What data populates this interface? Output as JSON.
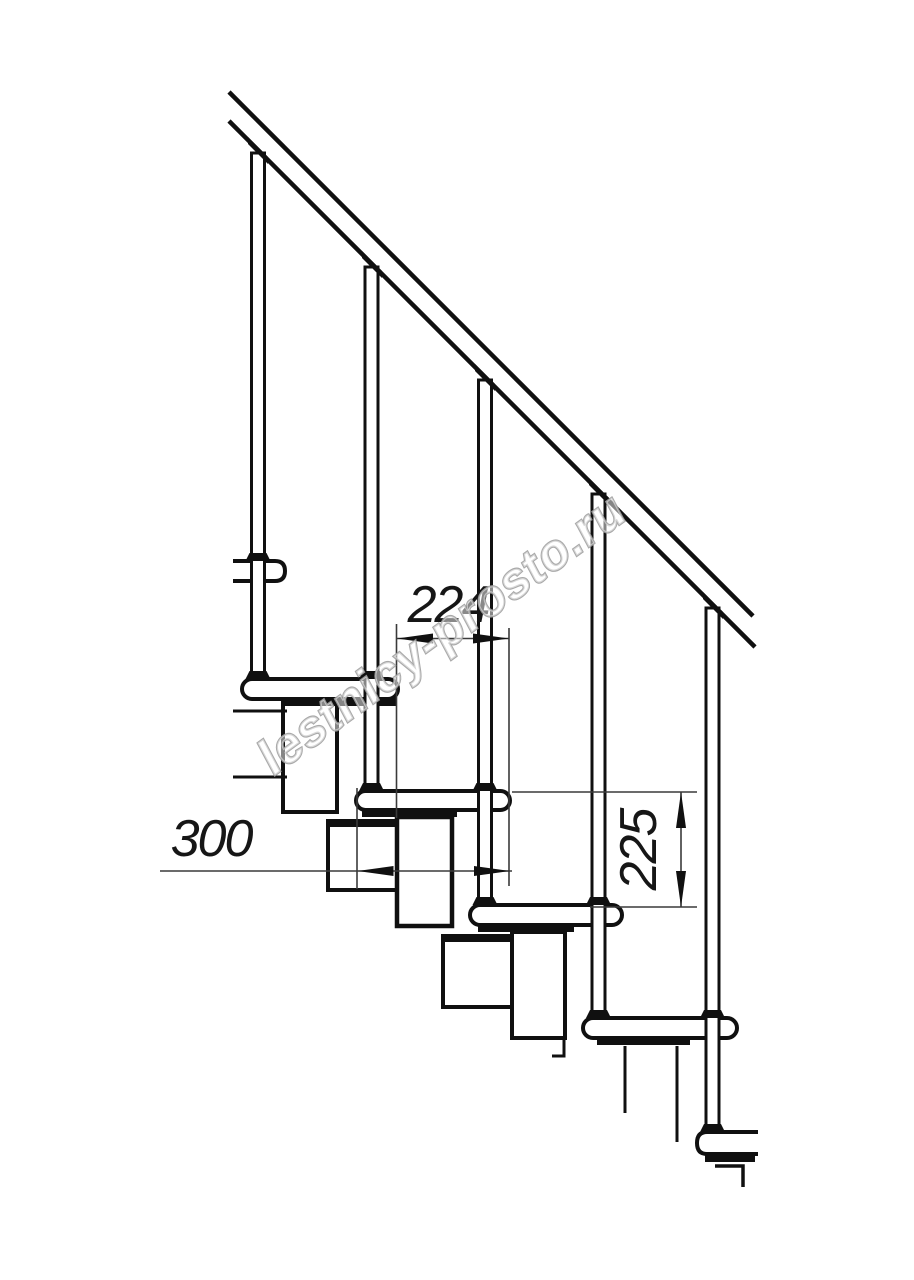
{
  "drawing": {
    "dimensions": {
      "dim_width": "224",
      "dim_depth": "300",
      "dim_rise": "225"
    },
    "watermark": "lestnicy-prosto.ru",
    "colors": {
      "line": "#101010",
      "dim_line": "#3a3a3a",
      "watermark_stroke": "#a0a0a0",
      "background": "#ffffff"
    }
  }
}
